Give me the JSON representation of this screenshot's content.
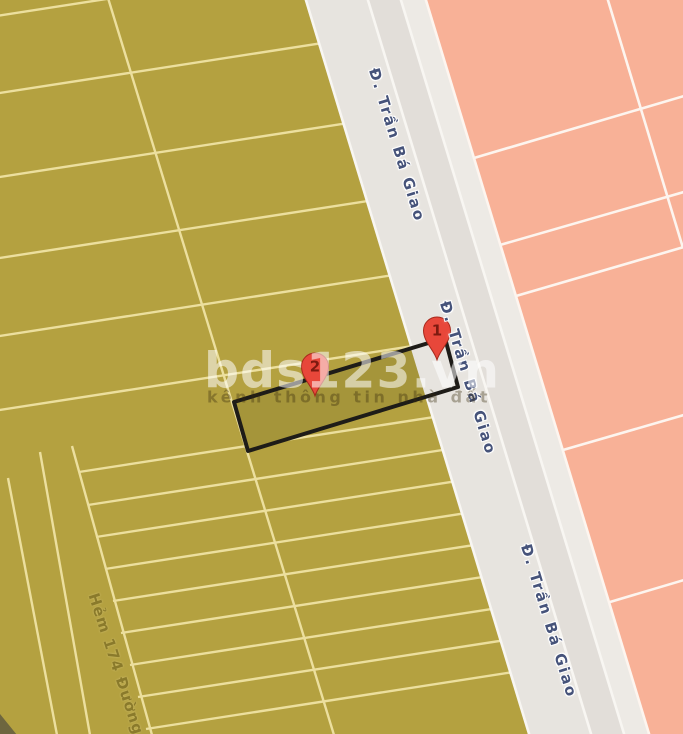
{
  "map": {
    "type": "cadastral-map",
    "watermark": {
      "brand": "bds123.vn",
      "tagline": "kênh thông tin nhà đất"
    },
    "road_labels": [
      {
        "text": "Đ. Trần Bá Giao"
      },
      {
        "text": "Đ. Trần Bá Giao"
      },
      {
        "text": "Đ. Trần Bá Giao"
      }
    ],
    "alley_label": "Hẻm 174 Đường",
    "markers": [
      {
        "label": "1"
      },
      {
        "label": "2"
      }
    ],
    "colors": {
      "parcel_fill": "#b4a140",
      "parcel_line": "#ecdf9e",
      "road_fill": "#e7e4df",
      "road_line": "#f8f6f2",
      "zone_fill": "#f8b197",
      "zone_line": "#fdf5ef",
      "plot_fill": "#a5953a",
      "plot_border": "#1e1c18",
      "marker_red": "#e8473a",
      "road_label_color": "#46537a",
      "alley_label_color": "#8a7a2b"
    }
  }
}
